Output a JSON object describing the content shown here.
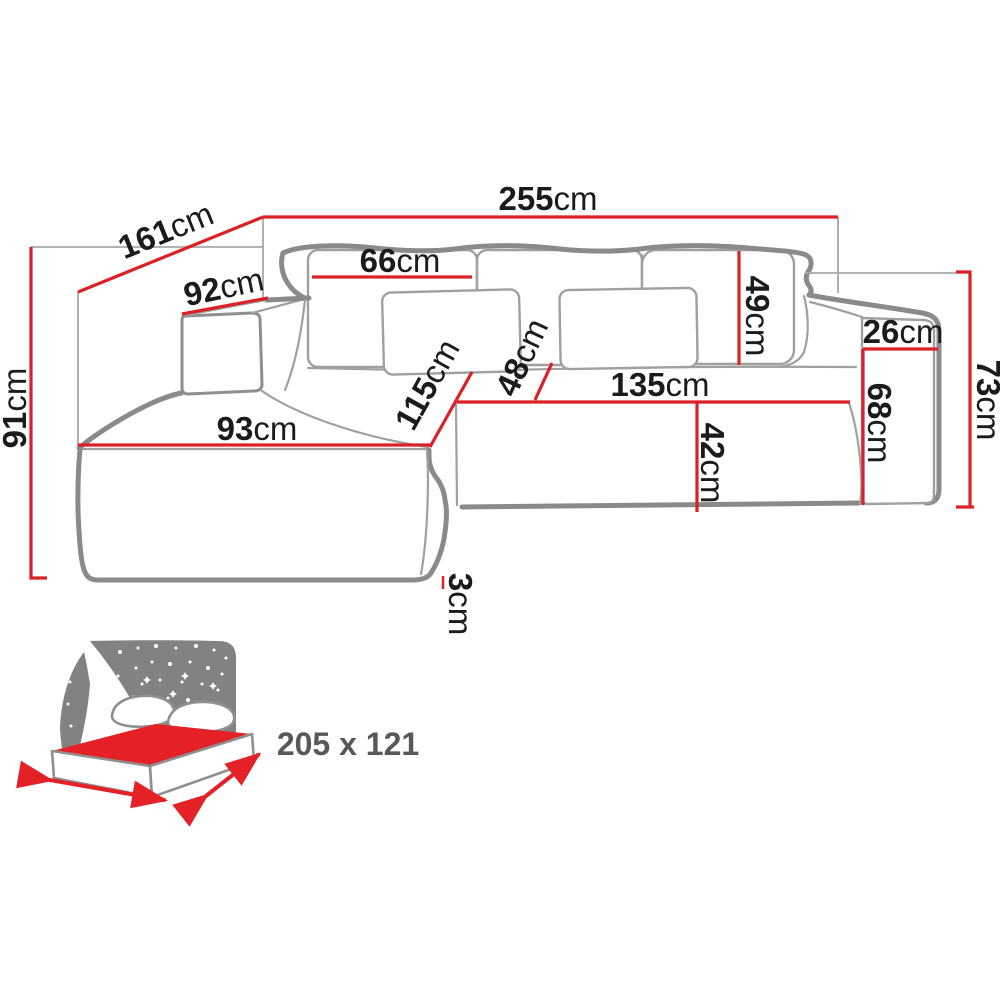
{
  "diagram": {
    "title": "corner-sofa-dimension-diagram",
    "unit": "cm",
    "colors": {
      "dimension_line": "#da2128",
      "sofa_outline": "#8a8a8a",
      "label_text": "#1b1b1b",
      "icon_gray": "#828282",
      "icon_red": "#e32126",
      "icon_label_text": "#585858",
      "background": "#ffffff"
    },
    "dimensions": {
      "total_width": {
        "value": "255",
        "unit": "cm"
      },
      "total_depth": {
        "value": "161",
        "unit": "cm"
      },
      "chaise_arm_depth": {
        "value": "92",
        "unit": "cm"
      },
      "total_height": {
        "value": "91",
        "unit": "cm"
      },
      "back_cushion_width": {
        "value": "66",
        "unit": "cm"
      },
      "back_cushion_height": {
        "value": "49",
        "unit": "cm"
      },
      "armrest_width": {
        "value": "26",
        "unit": "cm"
      },
      "armrest_height": {
        "value": "73",
        "unit": "cm"
      },
      "armrest_front_height": {
        "value": "68",
        "unit": "cm"
      },
      "chaise_width": {
        "value": "93",
        "unit": "cm"
      },
      "chaise_length": {
        "value": "115",
        "unit": "cm"
      },
      "seat_depth": {
        "value": "48",
        "unit": "cm"
      },
      "seat_width": {
        "value": "135",
        "unit": "cm"
      },
      "seat_height": {
        "value": "42",
        "unit": "cm"
      },
      "leg_height": {
        "value": "3",
        "unit": "cm"
      }
    },
    "sleeping_area": {
      "label": "205 x 121"
    }
  }
}
